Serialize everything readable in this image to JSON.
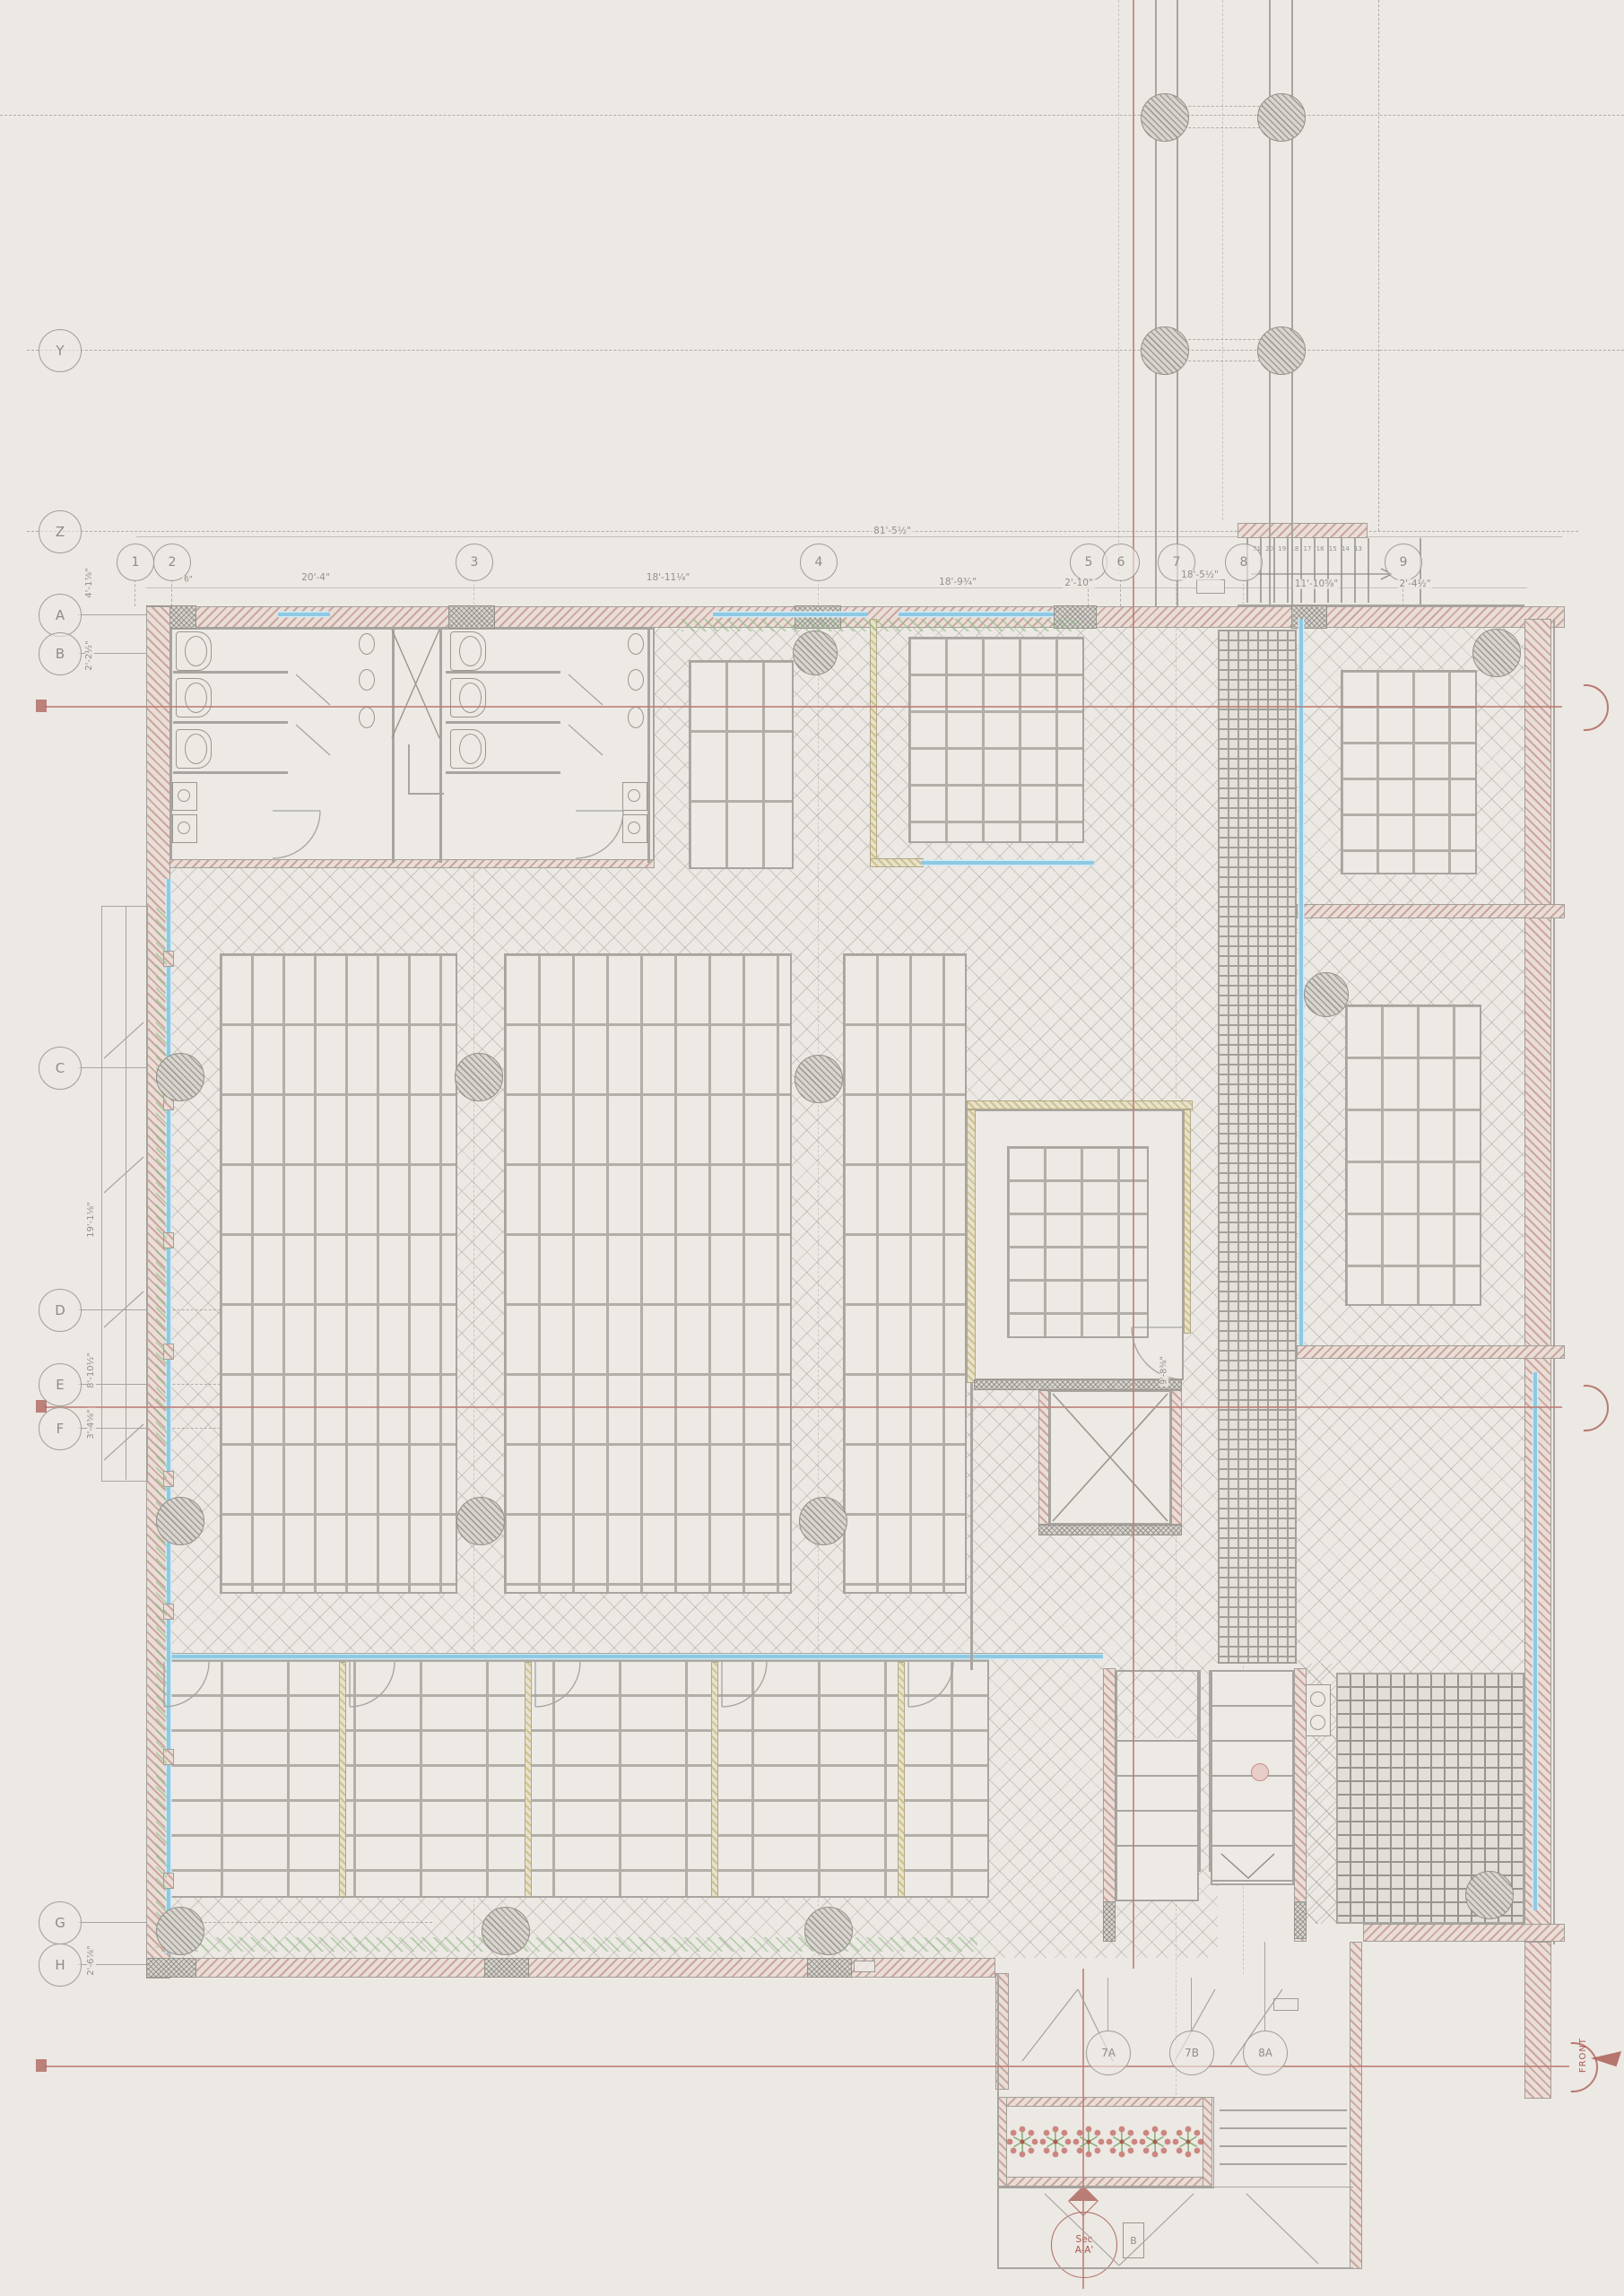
{
  "grid": {
    "row_labels": [
      "Y",
      "Z",
      "A",
      "B",
      "C",
      "D",
      "E",
      "F",
      "G",
      "H"
    ],
    "column_labels": [
      "1",
      "2",
      "3",
      "4",
      "5",
      "6",
      "7",
      "8",
      "9"
    ],
    "bottom_column_labels": [
      "7A",
      "7B",
      "8A"
    ]
  },
  "dimensions": {
    "overall_width": "81'-5½\"",
    "horizontal": [
      "6\"",
      "20'-4\"",
      "18'-11¼\"",
      "18'-9¾\"",
      "2'-10\"",
      "18'-5½\"",
      "11'-10⅝\"",
      "2'-4½\""
    ],
    "vertical": [
      "4'-1⅞\"",
      "2'-2½\"",
      "19'-1⅛\"",
      "8'-10½\"",
      "3'-4⅝\"",
      "2'-6⅞\""
    ],
    "door_dim": "9'-8⅜\""
  },
  "stair": {
    "tread_numbers": [
      "21",
      "20",
      "19",
      "18",
      "17",
      "16",
      "15",
      "14",
      "13"
    ]
  },
  "markers": {
    "section_circle": {
      "line1": "Sec",
      "line2": "A-A'"
    },
    "b_tag": "B",
    "front_label": "FRONT"
  },
  "colors": {
    "paper": "#ece8e3",
    "line_gray": "#a8a5a0",
    "wall_hatch_red": "#b27870",
    "section_red": "#a85a52",
    "glazing_blue": "#8ec9e4",
    "plant_green": "#8abc80",
    "partition_yellow": "#b8a858"
  }
}
